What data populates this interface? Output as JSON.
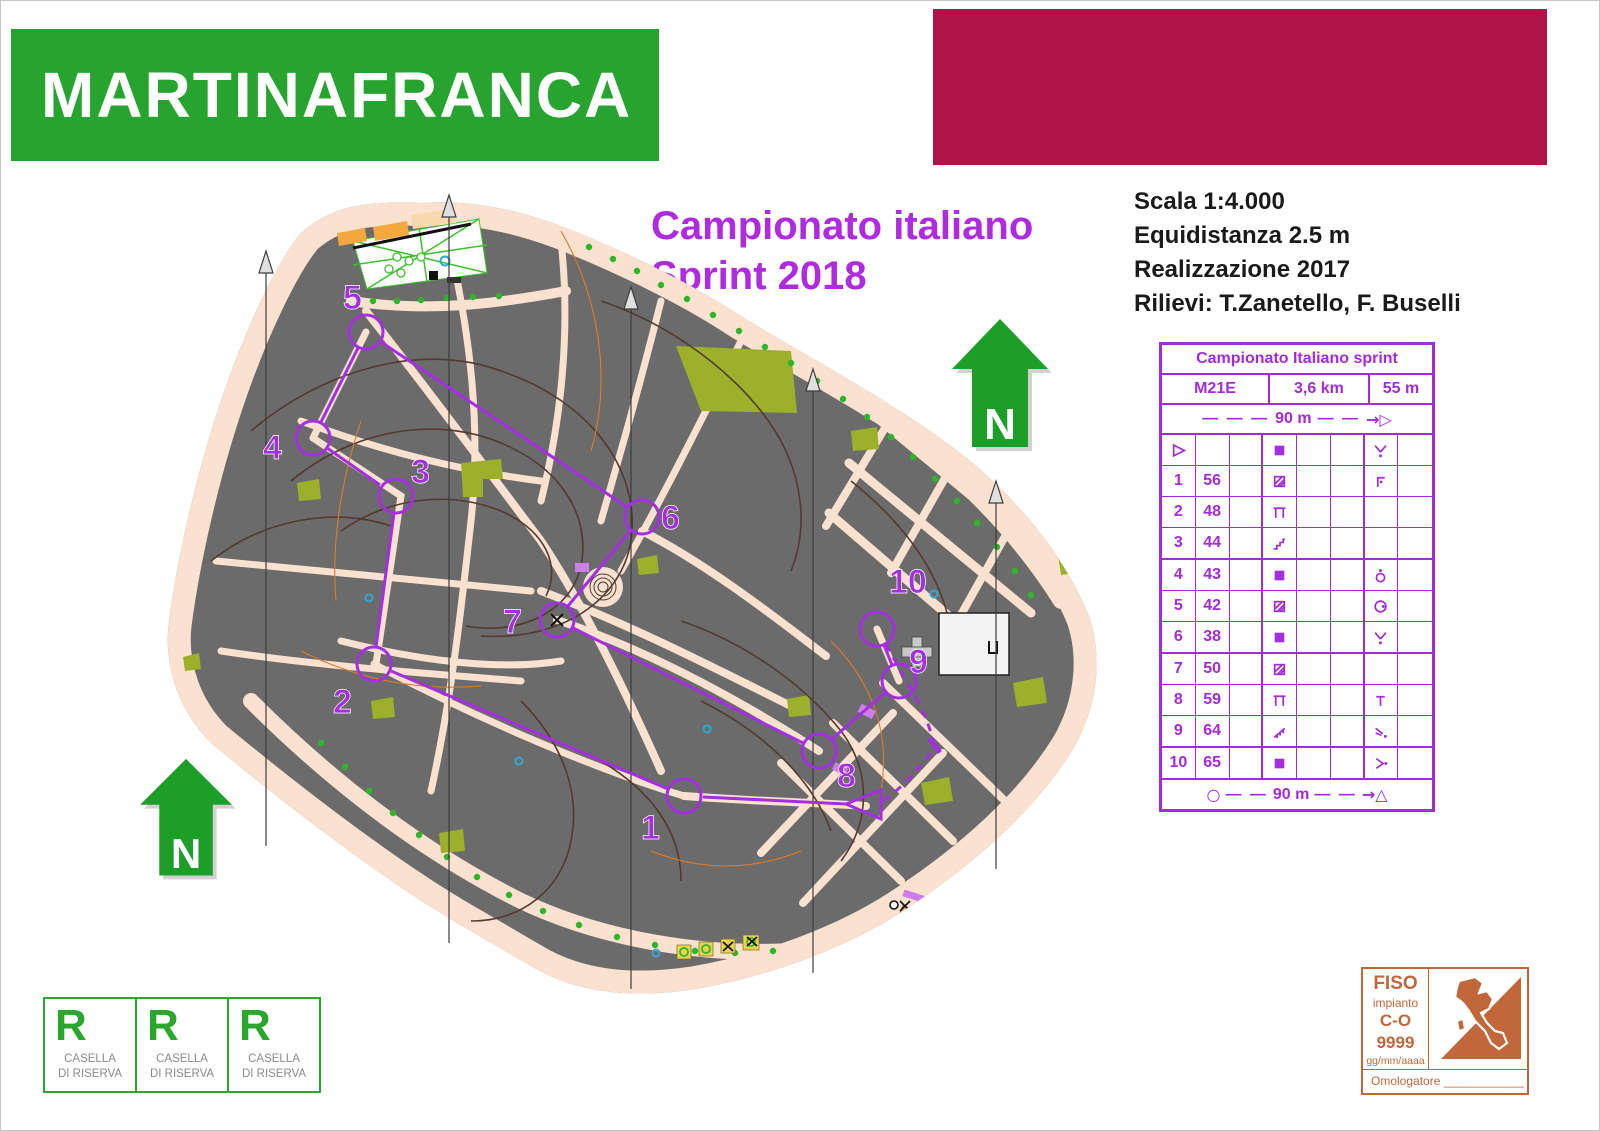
{
  "header": {
    "title": "MARTINAFRANCA",
    "title_bg": "#27a330",
    "accent_bar_color": "#b01448"
  },
  "event": {
    "title_line1": "Campionato italiano",
    "title_line2": "Sprint 2018",
    "color": "#ae2bdf"
  },
  "map_info": {
    "scale": "Scala 1:4.000",
    "equidistance": "Equidistanza 2.5 m",
    "realization": "Realizzazione 2017",
    "survey": "Rilievi: T.Zanetello, F. Buselli"
  },
  "north": {
    "label": "N",
    "color": "#1d9e28"
  },
  "course_table": {
    "title": "Campionato Italiano sprint",
    "category": "M21E",
    "length": "3,6 km",
    "climb": "55 m",
    "start_distance": "90 m",
    "finish_distance": "90 m",
    "accent": "#a32bd8",
    "rows": [
      {
        "num": "",
        "code": "",
        "d_symbol": "building",
        "g_symbol": "junction"
      },
      {
        "num": "1",
        "code": "56",
        "d_symbol": "canopy",
        "g_symbol": "corner"
      },
      {
        "num": "2",
        "code": "48",
        "d_symbol": "ruin",
        "g_symbol": ""
      },
      {
        "num": "3",
        "code": "44",
        "d_symbol": "stairway",
        "g_symbol": ""
      },
      {
        "num": "4",
        "code": "43",
        "d_symbol": "building",
        "g_symbol": "monument"
      },
      {
        "num": "5",
        "code": "42",
        "d_symbol": "canopy",
        "g_symbol": "well"
      },
      {
        "num": "6",
        "code": "38",
        "d_symbol": "building",
        "g_symbol": "junction"
      },
      {
        "num": "7",
        "code": "50",
        "d_symbol": "canopy",
        "g_symbol": ""
      },
      {
        "num": "8",
        "code": "59",
        "d_symbol": "ruin",
        "g_symbol": "tower"
      },
      {
        "num": "9",
        "code": "64",
        "d_symbol": "ramp",
        "g_symbol": "spur"
      },
      {
        "num": "10",
        "code": "65",
        "d_symbol": "building",
        "g_symbol": "east-side"
      }
    ],
    "symbols": {
      "start": "start-triangle",
      "finish": "finish-circle"
    }
  },
  "course": {
    "controls": [
      "1",
      "2",
      "3",
      "4",
      "5",
      "6",
      "7",
      "8",
      "9",
      "10"
    ],
    "purple": "#a42fe0"
  },
  "map_colors": {
    "open_land": "#fbe1cf",
    "building": "#6b6b6b",
    "vegetation": "#9cb02c",
    "tree_green": "#2fb52a",
    "contour": "#53392e",
    "water_blue": "#2fa8d0"
  },
  "reserve": {
    "letter": "R",
    "caption_line1": "CASELLA",
    "caption_line2": "DI RISERVA"
  },
  "approval": {
    "federation": "FISO",
    "line1": "impianto",
    "line2": "C-O",
    "number": "9999",
    "date_placeholder": "gg/mm/aaaa",
    "bottom_label": "Omologatore ____________",
    "color": "#c2673b"
  }
}
